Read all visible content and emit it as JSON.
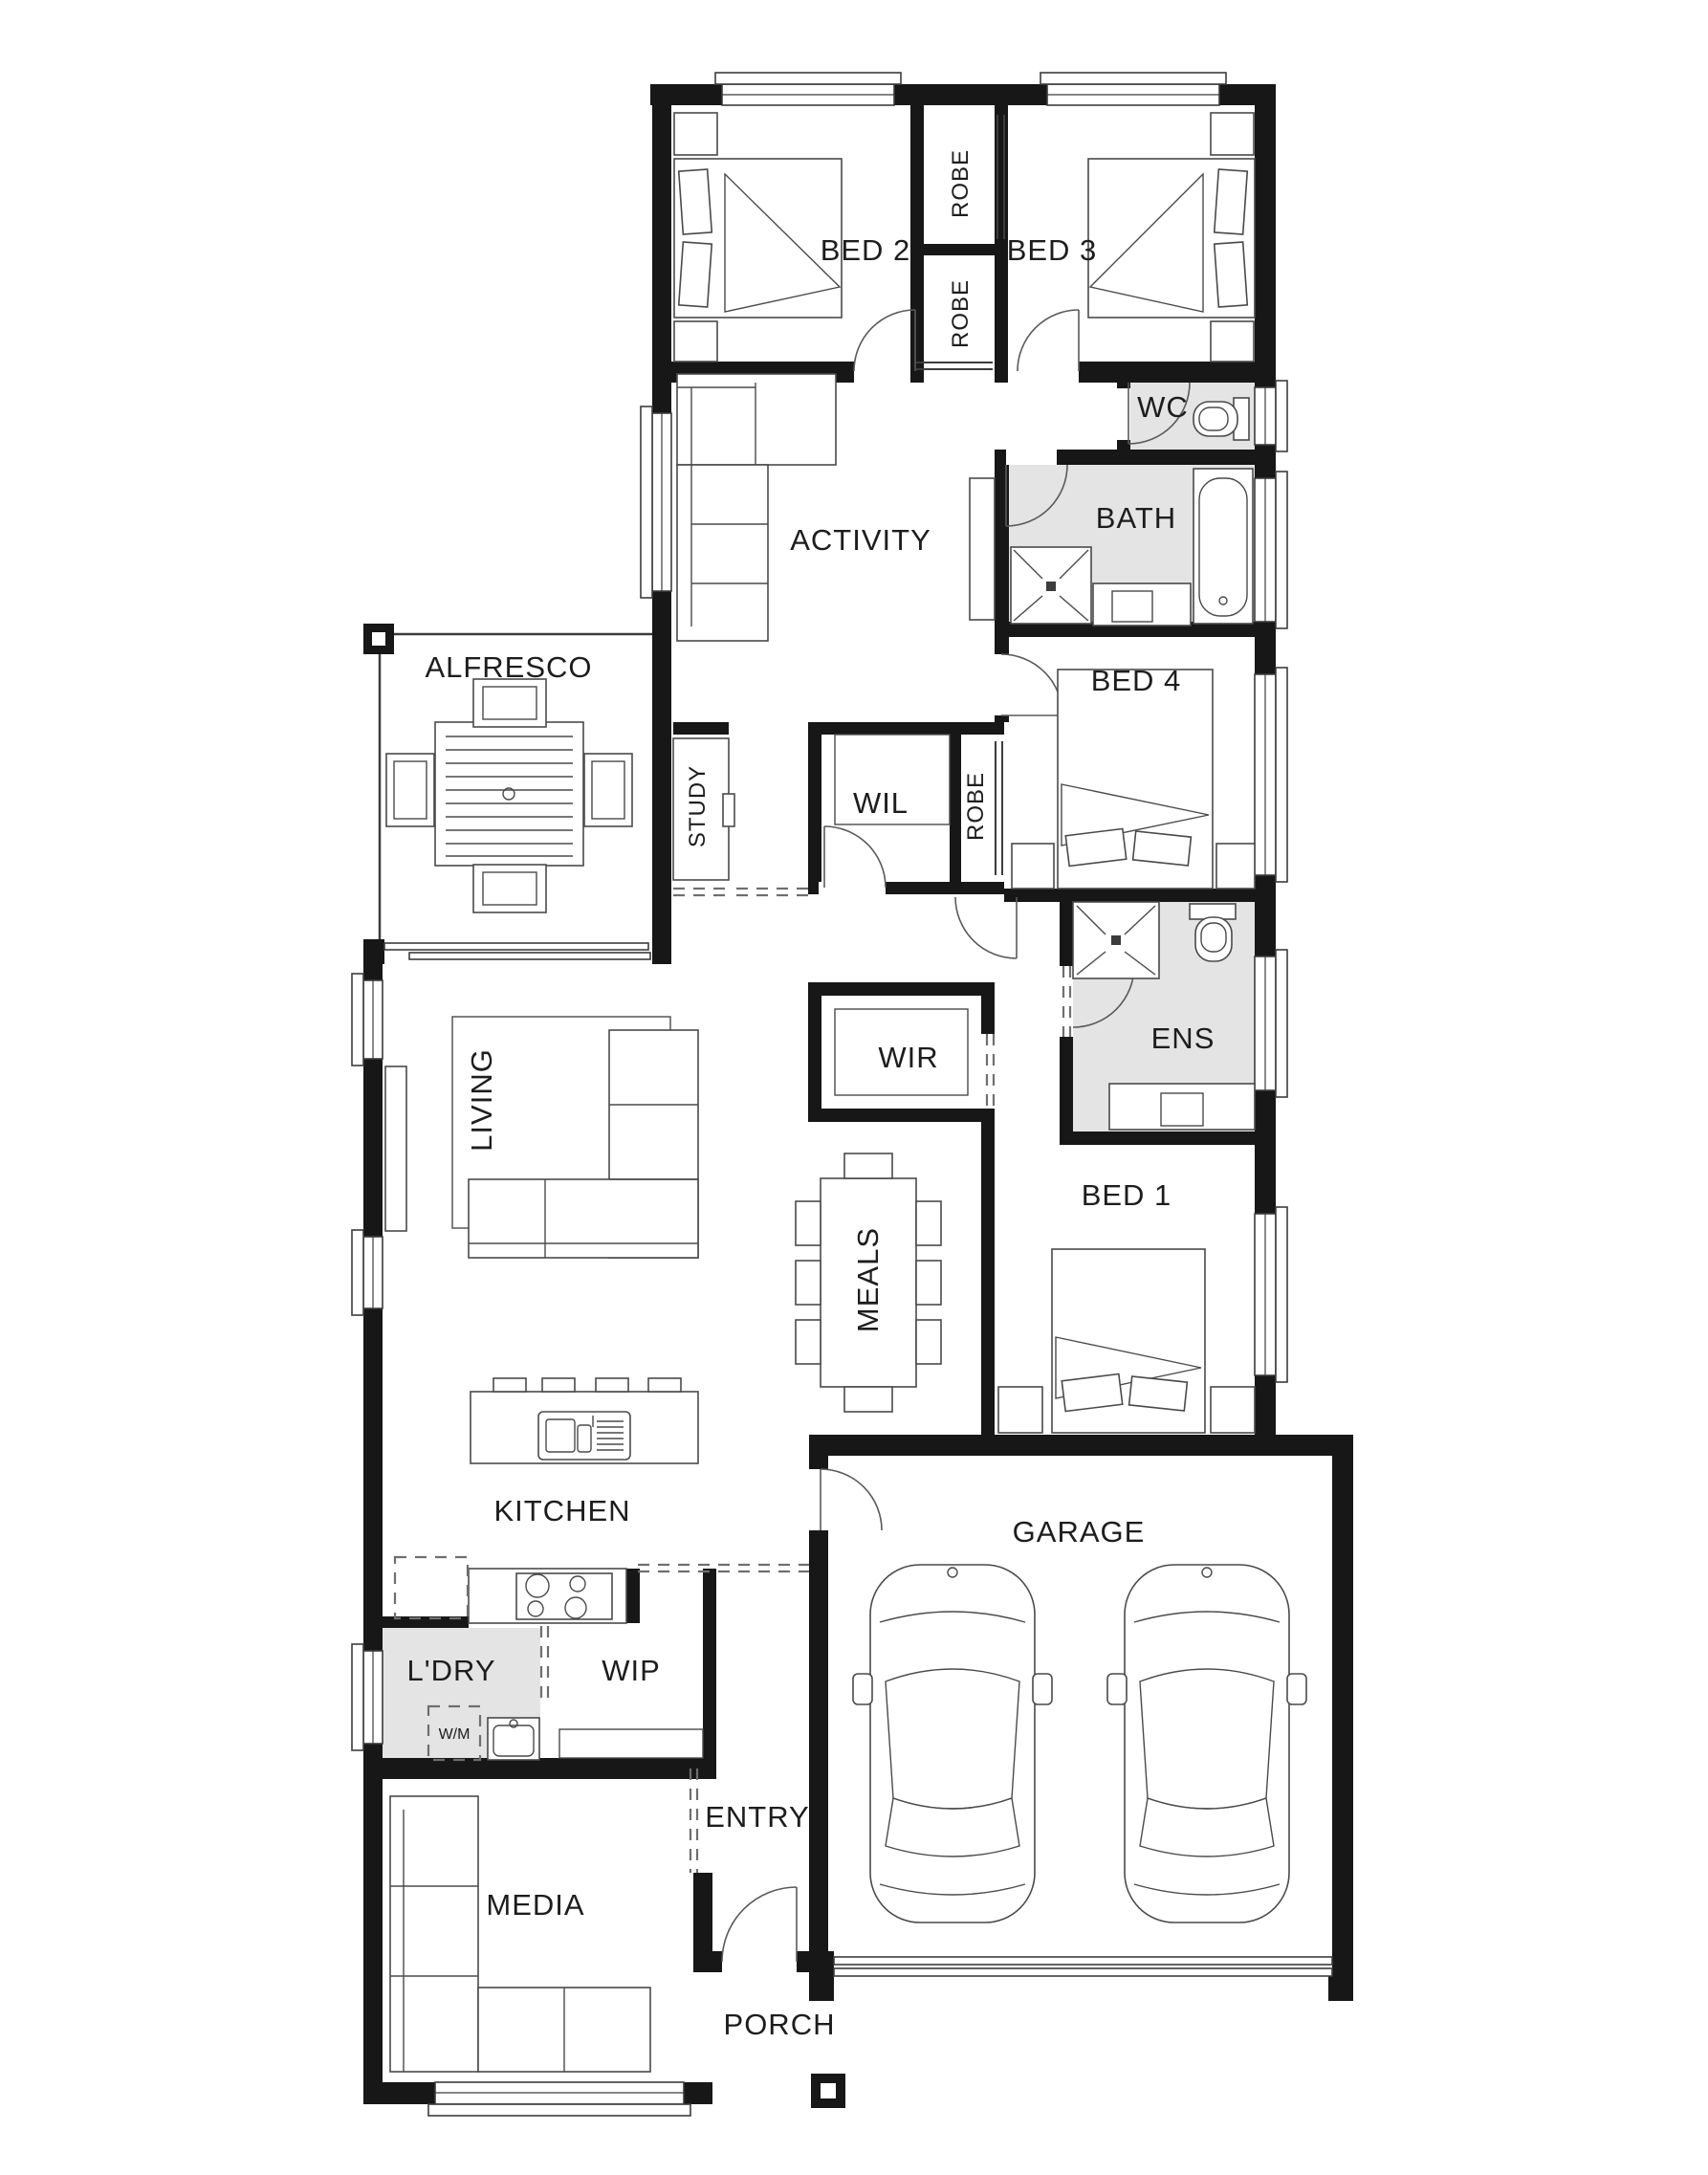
{
  "plan": {
    "background": "#ffffff",
    "colors": {
      "wall": "#171717",
      "wet_area": "#e4e4e4",
      "line": "#4a4a4a",
      "door": "#5a5a5a",
      "label": "#1d1d1d",
      "bg": "#ffffff"
    },
    "labels": {
      "bed2": "BED 2",
      "bed3": "BED 3",
      "robe_top": "ROBE",
      "robe_mid": "ROBE",
      "wc": "WC",
      "bath": "BATH",
      "activity": "ACTIVITY",
      "alfresco": "ALFRESCO",
      "bed4": "BED 4",
      "study": "STUDY",
      "wil": "WIL",
      "robe_bed4": "ROBE",
      "ens": "ENS",
      "wir": "WIR",
      "living": "LIVING",
      "bed1": "BED 1",
      "meals": "MEALS",
      "kitchen": "KITCHEN",
      "garage": "GARAGE",
      "ldry": "L'DRY",
      "wip": "WIP",
      "wm": "W/M",
      "entry": "ENTRY",
      "media": "MEDIA",
      "porch": "PORCH"
    }
  }
}
